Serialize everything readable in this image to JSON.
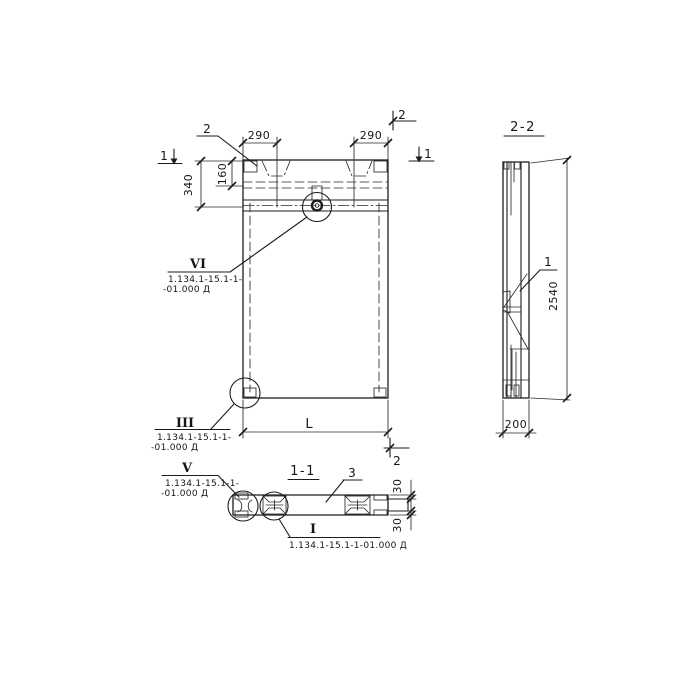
{
  "front_view": {
    "marker_1_left": "1",
    "marker_1_right": "1",
    "marker_2_top": "2",
    "marker_2_bottom": "2",
    "embed_label": "2",
    "dim_290_left": "290",
    "dim_290_right": "290",
    "dim_340": "340",
    "dim_160": "160",
    "dim_length": "L"
  },
  "side_view": {
    "title": "2-2",
    "rib_label": "1",
    "dim_height": "2540",
    "dim_thickness": "200"
  },
  "section_view": {
    "title": "1-1",
    "slab_label": "3",
    "dim_flange_top": "30",
    "dim_flange_bottom": "30"
  },
  "callouts": {
    "vi": {
      "label": "VI",
      "ref_line1": "1.134.1-15.1-1-",
      "ref_line2": "-01.000 Д"
    },
    "iii": {
      "label": "III",
      "ref_line1": "1.134.1-15.1-1-",
      "ref_line2": "-01.000 Д"
    },
    "v": {
      "label": "V",
      "ref_line1": "1.134.1-15.1-1-",
      "ref_line2": "-01.000 Д"
    },
    "i": {
      "label": "I",
      "ref": "1.134.1-15.1-1-01.000 Д"
    }
  },
  "colors": {
    "ink": "#1c1c1c",
    "paper": "#ffffff"
  }
}
